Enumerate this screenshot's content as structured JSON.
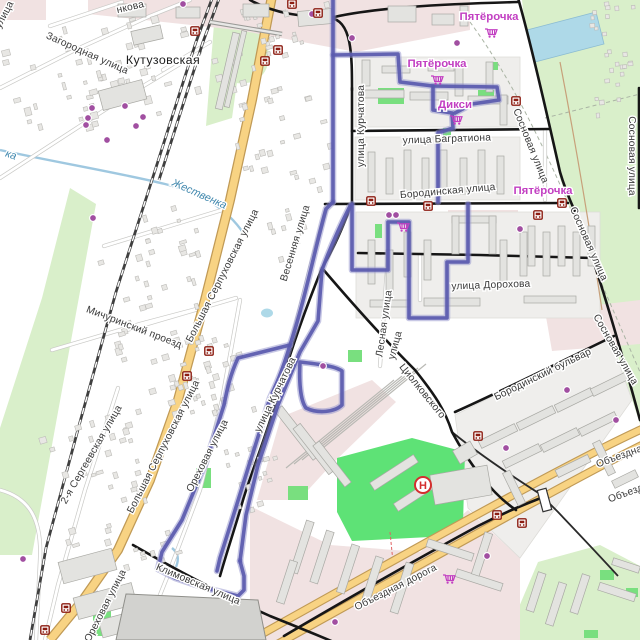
{
  "map": {
    "colors": {
      "route": "#5a5aae",
      "route_halo": "#9191cc",
      "road_primary": "#f8d383",
      "road_primary_casing": "#c09a56",
      "road_major": "#161616",
      "railway": "#3f3f3f",
      "park": "#d9efca",
      "grass_bright": "#5ee276",
      "water": "#aed9e8",
      "stream": "#9fc8e0",
      "industrial": "#f1e2e2",
      "residential": "#efeeec",
      "building": "#e3e3e0",
      "poi_dot": "#a14fa1",
      "bus_icon": "#8c1d12",
      "shop_label": "#c23fc2",
      "helipad": "#d42e2e"
    },
    "street_labels": [
      {
        "t": "нкова",
        "x": 131,
        "y": 10,
        "r": -13,
        "k": "street"
      },
      {
        "t": "улица",
        "x": 7,
        "y": 16,
        "r": -62,
        "k": "street"
      },
      {
        "t": "Загородная улица",
        "x": 86,
        "y": 56,
        "r": 24,
        "k": "street"
      },
      {
        "t": "Кутузовская",
        "x": 163,
        "y": 64,
        "r": 0,
        "k": "station"
      },
      {
        "t": "Жественка",
        "x": 198,
        "y": 197,
        "r": 24,
        "k": "water"
      },
      {
        "t": "ка",
        "x": 10,
        "y": 158,
        "r": 18,
        "k": "water"
      },
      {
        "t": "Мичуринский проезд",
        "x": 133,
        "y": 330,
        "r": 21,
        "k": "street"
      },
      {
        "t": "Большая Серпуховская улица",
        "x": 225,
        "y": 277,
        "r": -63,
        "k": "street"
      },
      {
        "t": "Большая Серпуховская улица",
        "x": 166,
        "y": 448,
        "r": -63,
        "k": "street"
      },
      {
        "t": "Весенняя улица",
        "x": 298,
        "y": 244,
        "r": -73,
        "k": "street"
      },
      {
        "t": "улица Курчатова",
        "x": 364,
        "y": 126,
        "r": -90,
        "k": "street"
      },
      {
        "t": "улица Курчатова",
        "x": 278,
        "y": 396,
        "r": -64,
        "k": "street"
      },
      {
        "t": "улица Багратиона",
        "x": 447,
        "y": 142,
        "r": -2,
        "k": "street"
      },
      {
        "t": "Бородинская улица",
        "x": 448,
        "y": 194,
        "r": -5,
        "k": "street"
      },
      {
        "t": "Сосновая улица",
        "x": 528,
        "y": 147,
        "r": 68,
        "k": "street"
      },
      {
        "t": "Сосновая улица",
        "x": 586,
        "y": 245,
        "r": 66,
        "k": "street"
      },
      {
        "t": "Сосновая улица",
        "x": 613,
        "y": 351,
        "r": 60,
        "k": "street"
      },
      {
        "t": "Сосновая улица",
        "x": 629,
        "y": 156,
        "r": 90,
        "k": "street"
      },
      {
        "t": "улица Дорохова",
        "x": 491,
        "y": 288,
        "r": -2,
        "k": "street"
      },
      {
        "t": "Лесная улица",
        "x": 387,
        "y": 324,
        "r": -82,
        "k": "street"
      },
      {
        "t": "улица",
        "x": 398,
        "y": 346,
        "r": -75,
        "k": "street"
      },
      {
        "t": "Циолковского",
        "x": 420,
        "y": 393,
        "r": 51,
        "k": "street"
      },
      {
        "t": "Бородинский бульвар",
        "x": 544,
        "y": 377,
        "r": -26,
        "k": "street"
      },
      {
        "t": "Объездная дорога",
        "x": 397,
        "y": 590,
        "r": -27,
        "k": "street"
      },
      {
        "t": "Объездная дорога",
        "x": 640,
        "y": 452,
        "r": -20,
        "k": "street"
      },
      {
        "t": "Объездная дорога",
        "x": 652,
        "y": 487,
        "r": -20,
        "k": "street"
      },
      {
        "t": "Климовская улица",
        "x": 197,
        "y": 587,
        "r": 23,
        "k": "street"
      },
      {
        "t": "2-я Сергеевская улица",
        "x": 94,
        "y": 456,
        "r": -60,
        "k": "street"
      },
      {
        "t": "Ореховая улица",
        "x": 210,
        "y": 457,
        "r": -63,
        "k": "street"
      },
      {
        "t": "Ореховая улица",
        "x": 108,
        "y": 607,
        "r": -63,
        "k": "street"
      }
    ],
    "shop_labels": [
      {
        "t": "Пятёрочка",
        "x": 489,
        "y": 20
      },
      {
        "t": "Пятёрочка",
        "x": 437,
        "y": 67
      },
      {
        "t": "Пятёрочка",
        "x": 543,
        "y": 194
      },
      {
        "t": "Дикси",
        "x": 455,
        "y": 108
      }
    ],
    "icons": {
      "shop_carts": [
        [
          491,
          33
        ],
        [
          437,
          80
        ],
        [
          456,
          120
        ],
        [
          403,
          227
        ],
        [
          449,
          579
        ]
      ],
      "bus_stops": [
        [
          195,
          31
        ],
        [
          292,
          4
        ],
        [
          318,
          13
        ],
        [
          278,
          50
        ],
        [
          265,
          61
        ],
        [
          516,
          101
        ],
        [
          371,
          201
        ],
        [
          428,
          206
        ],
        [
          538,
          215
        ],
        [
          562,
          203
        ],
        [
          209,
          351
        ],
        [
          187,
          376
        ],
        [
          478,
          436
        ],
        [
          497,
          515
        ],
        [
          522,
          523
        ],
        [
          66,
          608
        ],
        [
          45,
          630
        ]
      ],
      "poi_dots": [
        [
          183,
          4
        ],
        [
          312,
          14
        ],
        [
          352,
          38
        ],
        [
          457,
          43
        ],
        [
          92,
          108
        ],
        [
          88,
          118
        ],
        [
          86,
          125
        ],
        [
          125,
          106
        ],
        [
          143,
          117
        ],
        [
          136,
          126
        ],
        [
          107,
          140
        ],
        [
          93,
          218
        ],
        [
          389,
          215
        ],
        [
          396,
          215
        ],
        [
          520,
          229
        ],
        [
          323,
          366
        ],
        [
          567,
          390
        ],
        [
          616,
          420
        ],
        [
          506,
          448
        ],
        [
          487,
          556
        ],
        [
          335,
          622
        ],
        [
          23,
          559
        ]
      ],
      "helipad": [
        423,
        485
      ]
    }
  }
}
